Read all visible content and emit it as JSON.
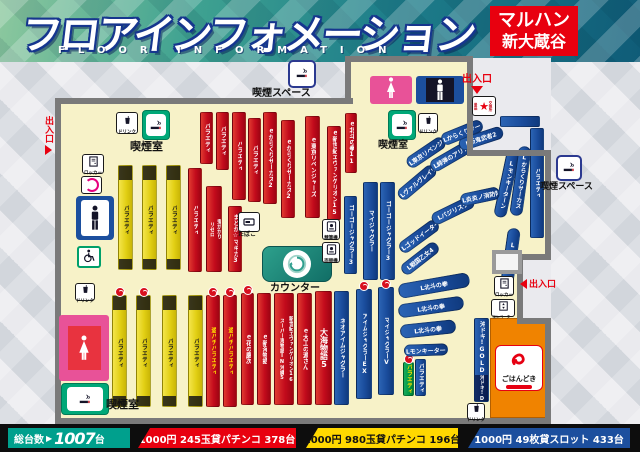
{
  "header": {
    "title": "フロアインフォメーション",
    "subtitle": "FLOOR INFORMATION",
    "store": {
      "line1": "マルハン",
      "line2": "新大蔵谷"
    }
  },
  "footer": {
    "total": {
      "label": "総台数",
      "arrow": "▶",
      "value": "1007",
      "unit": "台"
    },
    "rates": [
      {
        "text": "1000円 245玉貸パチンコ 378台",
        "bg": "#e8000f",
        "fg": "#ffffff",
        "x": 138,
        "w": 158
      },
      {
        "text": "1000円 980玉貸パチンコ 196台",
        "bg": "#ffd800",
        "fg": "#111111",
        "x": 306,
        "w": 152
      },
      {
        "text": "1000円 49枚貸スロット 433台",
        "bg": "#1c4f9e",
        "fg": "#ffffff",
        "x": 468,
        "w": 162
      }
    ]
  },
  "colors": {
    "accent_red": "#e8000f",
    "accent_teal": "#00a08d",
    "accent_yellow": "#ffd800",
    "accent_blue": "#1c4f9e",
    "floor": "#f7f2c8",
    "wall": "#7a7a7a"
  },
  "map": {
    "strips": [
      {
        "x": 118,
        "y": 165,
        "w": 15,
        "h": 105,
        "c": "y",
        "segs": [
          {
            "t": "",
            "d": 1,
            "h": 14
          },
          {
            "t": "バラエティ"
          },
          {
            "t": "",
            "d": 1,
            "h": 10
          }
        ]
      },
      {
        "x": 142,
        "y": 165,
        "w": 15,
        "h": 105,
        "c": "y",
        "segs": [
          {
            "t": "",
            "d": 1,
            "h": 14
          },
          {
            "t": "バラエティ"
          },
          {
            "t": "",
            "d": 1,
            "h": 10
          }
        ]
      },
      {
        "x": 166,
        "y": 165,
        "w": 15,
        "h": 105,
        "c": "y",
        "segs": [
          {
            "t": "",
            "d": 1,
            "h": 14
          },
          {
            "t": "バラエティ"
          },
          {
            "t": "",
            "d": 1,
            "h": 10
          }
        ]
      },
      {
        "x": 188,
        "y": 168,
        "w": 14,
        "h": 104,
        "c": "r",
        "label": "バラエティ"
      },
      {
        "x": 206,
        "y": 186,
        "w": 16,
        "h": 86,
        "c": "r",
        "cols": [
          "リゼロ",
          "鬼がかり"
        ]
      },
      {
        "x": 228,
        "y": 206,
        "w": 14,
        "h": 66,
        "c": "r",
        "label": "まどか☆マギカ3"
      },
      {
        "x": 200,
        "y": 112,
        "w": 13,
        "h": 52,
        "c": "r",
        "label": "バラエティ"
      },
      {
        "x": 216,
        "y": 112,
        "w": 13,
        "h": 58,
        "c": "r",
        "label": "バラエティ"
      },
      {
        "x": 232,
        "y": 112,
        "w": 14,
        "h": 88,
        "c": "r",
        "label": "バラエティ"
      },
      {
        "x": 248,
        "y": 118,
        "w": 13,
        "h": 84,
        "c": "r",
        "label": "バラエティ"
      },
      {
        "x": 263,
        "y": 112,
        "w": 14,
        "h": 92,
        "c": "r",
        "label": "ｅからくりサーカス2"
      },
      {
        "x": 281,
        "y": 120,
        "w": 14,
        "h": 98,
        "c": "r",
        "label": "ｅからくりサーカス2"
      },
      {
        "x": 305,
        "y": 116,
        "w": 15,
        "h": 102,
        "c": "r",
        "label": "ｅ東京リベンジャーズ"
      },
      {
        "x": 327,
        "y": 126,
        "w": 14,
        "h": 94,
        "c": "r",
        "label": "ｅ新世紀エヴァンゲリオン15"
      },
      {
        "x": 345,
        "y": 113,
        "w": 12,
        "h": 60,
        "c": "r",
        "label": "ｅ北斗の拳11"
      },
      {
        "x": 344,
        "y": 196,
        "w": 13,
        "h": 78,
        "c": "b",
        "label": "ゴーゴージャグラー3"
      },
      {
        "x": 363,
        "y": 182,
        "w": 15,
        "h": 98,
        "c": "b",
        "label": "マイジャグラー"
      },
      {
        "x": 380,
        "y": 182,
        "w": 15,
        "h": 98,
        "c": "b",
        "label": "ゴーゴージャグラー3"
      },
      {
        "x": 112,
        "y": 295,
        "w": 15,
        "h": 112,
        "c": "y",
        "badge": 1,
        "segs": [
          {
            "t": "",
            "d": 1,
            "h": 14
          },
          {
            "t": "バラエティ"
          },
          {
            "t": "",
            "d": 1,
            "h": 10
          }
        ]
      },
      {
        "x": 136,
        "y": 295,
        "w": 15,
        "h": 112,
        "c": "y",
        "badge": 1,
        "segs": [
          {
            "t": "",
            "d": 1,
            "h": 14
          },
          {
            "t": "バラエティ"
          },
          {
            "t": "",
            "d": 1,
            "h": 10
          }
        ]
      },
      {
        "x": 162,
        "y": 295,
        "w": 15,
        "h": 112,
        "c": "y",
        "segs": [
          {
            "t": "",
            "d": 1,
            "h": 14
          },
          {
            "t": "バラエティ"
          },
          {
            "t": "",
            "d": 1,
            "h": 10
          }
        ]
      },
      {
        "x": 188,
        "y": 295,
        "w": 15,
        "h": 112,
        "c": "y",
        "segs": [
          {
            "t": "",
            "d": 1,
            "h": 14
          },
          {
            "t": "バラエティ"
          },
          {
            "t": "",
            "d": 1,
            "h": 10
          }
        ]
      },
      {
        "x": 206,
        "y": 295,
        "w": 14,
        "h": 112,
        "c": "r",
        "label": "遊パチバラエティ",
        "fg": "#ffe000",
        "badge": 1
      },
      {
        "x": 223,
        "y": 295,
        "w": 14,
        "h": 112,
        "c": "r",
        "label": "遊パチバラエティ",
        "fg": "#ffe000",
        "badge": 1
      },
      {
        "x": 241,
        "y": 293,
        "w": 13,
        "h": 112,
        "c": "r",
        "label": "ｅ花の慶次",
        "badge": 1
      },
      {
        "x": 257,
        "y": 293,
        "w": 14,
        "h": 112,
        "c": "r",
        "label": "ｅ新海物語"
      },
      {
        "x": 274,
        "y": 293,
        "w": 20,
        "h": 112,
        "c": "r",
        "cols": [
          "スーパー海物語IN沖縄5",
          "新世紀エヴァンゲリオン16"
        ]
      },
      {
        "x": 297,
        "y": 293,
        "w": 15,
        "h": 112,
        "c": "r",
        "label": "ｅ大工の源さん"
      },
      {
        "x": 315,
        "y": 291,
        "w": 17,
        "h": 114,
        "c": "r",
        "label": "大海物語5",
        "big": 1
      },
      {
        "x": 334,
        "y": 291,
        "w": 15,
        "h": 114,
        "c": "b",
        "label": "ネオアイムジャグラー"
      },
      {
        "x": 356,
        "y": 289,
        "w": 16,
        "h": 110,
        "c": "b",
        "label": "アイムジャグラーEX",
        "badge": 1
      },
      {
        "x": 378,
        "y": 287,
        "w": 16,
        "h": 108,
        "c": "b",
        "label": "マイジャグラーV",
        "badge": 1
      },
      {
        "x": 403,
        "y": 362,
        "w": 11,
        "h": 34,
        "c": "g",
        "label": "バラエティ",
        "fg": "#ffe000",
        "badge": 1
      },
      {
        "x": 415,
        "y": 359,
        "w": 11,
        "h": 37,
        "c": "b",
        "label": "バラエティ"
      },
      {
        "x": 394,
        "y": 176,
        "w": 46,
        "h": 13,
        "c": "b",
        "rot": -40,
        "tdir": "h",
        "label": "Lヴァルヴレイヴ"
      },
      {
        "x": 428,
        "y": 150,
        "w": 46,
        "h": 13,
        "c": "b",
        "rot": -30,
        "tdir": "h",
        "label": "L緋弾のアリア"
      },
      {
        "x": 458,
        "y": 132,
        "w": 46,
        "h": 13,
        "c": "b",
        "rot": -18,
        "tdir": "h",
        "label": "L新鬼武者2"
      },
      {
        "x": 404,
        "y": 146,
        "w": 44,
        "h": 13,
        "c": "b",
        "rot": -34,
        "tdir": "h",
        "label": "L東京リベンジャーズ"
      },
      {
        "x": 440,
        "y": 126,
        "w": 44,
        "h": 13,
        "c": "b",
        "rot": -22,
        "tdir": "h",
        "label": "Lからくりサーカス"
      },
      {
        "x": 500,
        "y": 116,
        "w": 40,
        "h": 11,
        "c": "b"
      },
      {
        "x": 500,
        "y": 150,
        "w": 13,
        "h": 68,
        "c": "b",
        "rot": 12,
        "label": "Lモンキーターン"
      },
      {
        "x": 514,
        "y": 146,
        "w": 13,
        "h": 70,
        "c": "b",
        "rot": 8,
        "label": "Lからくりサーカス"
      },
      {
        "x": 530,
        "y": 128,
        "w": 14,
        "h": 110,
        "c": "b",
        "label": "バラエティ"
      },
      {
        "x": 396,
        "y": 230,
        "w": 46,
        "h": 13,
        "c": "b",
        "rot": -36,
        "tdir": "h",
        "label": "Lゴッドイーター"
      },
      {
        "x": 430,
        "y": 204,
        "w": 46,
        "h": 13,
        "c": "b",
        "rot": -26,
        "tdir": "h",
        "label": "Lバジリスク"
      },
      {
        "x": 460,
        "y": 190,
        "w": 40,
        "h": 13,
        "c": "b",
        "rot": -12,
        "tdir": "h",
        "label": "L炎炎ノ消防隊"
      },
      {
        "x": 398,
        "y": 252,
        "w": 44,
        "h": 13,
        "c": "b",
        "rot": -38,
        "tdir": "h",
        "label": "L戦国乙女4"
      },
      {
        "x": 398,
        "y": 278,
        "w": 72,
        "h": 15,
        "c": "b",
        "rot": -10,
        "tdir": "h",
        "label": "L北斗の拳"
      },
      {
        "x": 398,
        "y": 300,
        "w": 66,
        "h": 14,
        "c": "b",
        "rot": -8,
        "tdir": "h",
        "label": "L北斗の拳"
      },
      {
        "x": 400,
        "y": 322,
        "w": 56,
        "h": 14,
        "c": "b",
        "rot": -6,
        "tdir": "h",
        "label": "L北斗の拳"
      },
      {
        "x": 404,
        "y": 344,
        "w": 44,
        "h": 12,
        "c": "b",
        "rot": -2,
        "tdir": "h",
        "label": "Lモンキーターン"
      },
      {
        "x": 504,
        "y": 228,
        "w": 13,
        "h": 58,
        "c": "b",
        "rot": 8,
        "label": "Lいざ番長"
      },
      {
        "x": 474,
        "y": 318,
        "w": 15,
        "h": 84,
        "c": "b",
        "segs": [
          {
            "t": "沖ドキ!GOLD"
          },
          {
            "t": "沖ドキ!DUO",
            "d": 1,
            "h": 26
          }
        ]
      }
    ],
    "facilities": [
      {
        "t": "drink",
        "label": "ドリンク",
        "x": 116,
        "y": 112,
        "w": 22,
        "h": 22
      },
      {
        "t": "smokeroom",
        "x": 142,
        "y": 110,
        "w": 28,
        "h": 30
      },
      {
        "t": "maplabel",
        "label": "喫煙室",
        "x": 130,
        "y": 141,
        "fs": 11
      },
      {
        "t": "locker",
        "label": "ロッカー",
        "x": 82,
        "y": 154,
        "w": 22,
        "h": 20
      },
      {
        "t": "memberlogo",
        "x": 81,
        "y": 176,
        "w": 21,
        "h": 18
      },
      {
        "t": "wcmale",
        "x": 76,
        "y": 196,
        "w": 38,
        "h": 44
      },
      {
        "t": "wheelchair",
        "x": 77,
        "y": 246,
        "w": 24,
        "h": 22
      },
      {
        "t": "drink",
        "label": "ドリンク",
        "x": 75,
        "y": 283,
        "w": 20,
        "h": 18
      },
      {
        "t": "wcfemale",
        "x": 59,
        "y": 315,
        "w": 50,
        "h": 66
      },
      {
        "t": "smokeroom",
        "x": 61,
        "y": 383,
        "w": 48,
        "h": 32
      },
      {
        "t": "maplabel",
        "label": "喫煙室",
        "x": 106,
        "y": 399,
        "fs": 11
      },
      {
        "t": "tabaco",
        "label": "たばこ",
        "x": 238,
        "y": 212,
        "w": 20,
        "h": 26
      },
      {
        "t": "counter",
        "x": 262,
        "y": 246,
        "w": 70,
        "h": 36
      },
      {
        "t": "maplabel",
        "label": "カウンター",
        "x": 270,
        "y": 284,
        "fs": 10
      },
      {
        "t": "machine",
        "label": "精算機",
        "x": 322,
        "y": 219,
        "w": 18,
        "h": 21
      },
      {
        "t": "machine",
        "label": "両替機",
        "x": 322,
        "y": 242,
        "w": 18,
        "h": 21
      },
      {
        "t": "smokeroom",
        "x": 388,
        "y": 110,
        "w": 28,
        "h": 30
      },
      {
        "t": "drink",
        "label": "ドリンク",
        "x": 418,
        "y": 113,
        "w": 20,
        "h": 20
      },
      {
        "t": "maplabel",
        "label": "喫煙室",
        "x": 378,
        "y": 141,
        "fs": 10
      },
      {
        "t": "smokespace",
        "x": 288,
        "y": 60,
        "w": 28,
        "h": 28
      },
      {
        "t": "maplabel",
        "label": "喫煙スペース",
        "x": 252,
        "y": 89,
        "fs": 10
      },
      {
        "t": "smokespace",
        "x": 556,
        "y": 155,
        "w": 26,
        "h": 26
      },
      {
        "t": "maplabel",
        "label": "喫煙スペース",
        "x": 540,
        "y": 183,
        "fs": 9
      },
      {
        "t": "star",
        "label": "景品交換所",
        "x": 472,
        "y": 96,
        "w": 24,
        "h": 20
      },
      {
        "t": "wcfemaletop",
        "x": 370,
        "y": 76,
        "w": 42,
        "h": 28
      },
      {
        "t": "wcmaletop",
        "x": 416,
        "y": 76,
        "w": 48,
        "h": 28
      },
      {
        "t": "locker",
        "label": "ロッカー",
        "x": 494,
        "y": 276,
        "w": 20,
        "h": 20
      },
      {
        "t": "elevator",
        "label": "エレベーター",
        "x": 491,
        "y": 299,
        "w": 24,
        "h": 18
      },
      {
        "t": "gohandoki",
        "label": "ごはんどき",
        "x": 490,
        "y": 318,
        "w": 58,
        "h": 100
      },
      {
        "t": "drink",
        "label": "ドリンク",
        "x": 467,
        "y": 403,
        "w": 18,
        "h": 17
      },
      {
        "t": "door",
        "x": 492,
        "y": 250,
        "w": 30,
        "h": 24
      },
      {
        "t": "entrance-left",
        "label": "出入口",
        "x": 42,
        "y": 116
      },
      {
        "t": "entrance-top",
        "label": "出入口",
        "x": 462,
        "y": 70
      },
      {
        "t": "entrance-right",
        "label": "出入口",
        "x": 520,
        "y": 277
      }
    ]
  }
}
